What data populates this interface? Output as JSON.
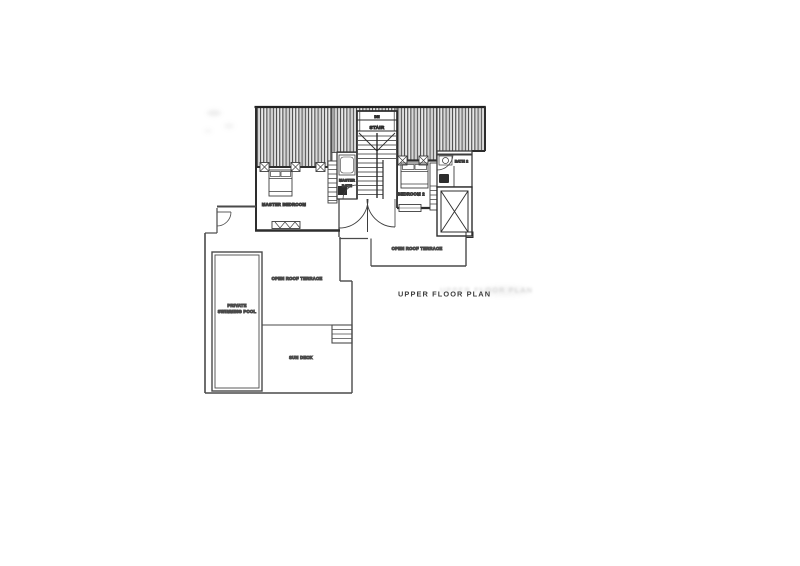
{
  "plan": {
    "title": "UPPER FLOOR PLAN",
    "stair": {
      "direction": "DN",
      "label": "STAIR"
    },
    "rooms": {
      "master_bedroom": "MASTER BEDROOM",
      "master_bath_line1": "MASTER",
      "master_bath_line2": "BATH",
      "bedroom_2": "BEDROOM 2",
      "bath_2": "BATH 2"
    },
    "terraces": {
      "upper": "OPEN ROOF TERRACE",
      "lower": "OPEN ROOF TERRACE"
    },
    "pool": {
      "line1": "PRIVATE",
      "line2": "SWIMMING POOL"
    },
    "sun_deck": "SUN DECK",
    "ink_color": "#3a3a3a",
    "paper_color": "#ffffff"
  }
}
